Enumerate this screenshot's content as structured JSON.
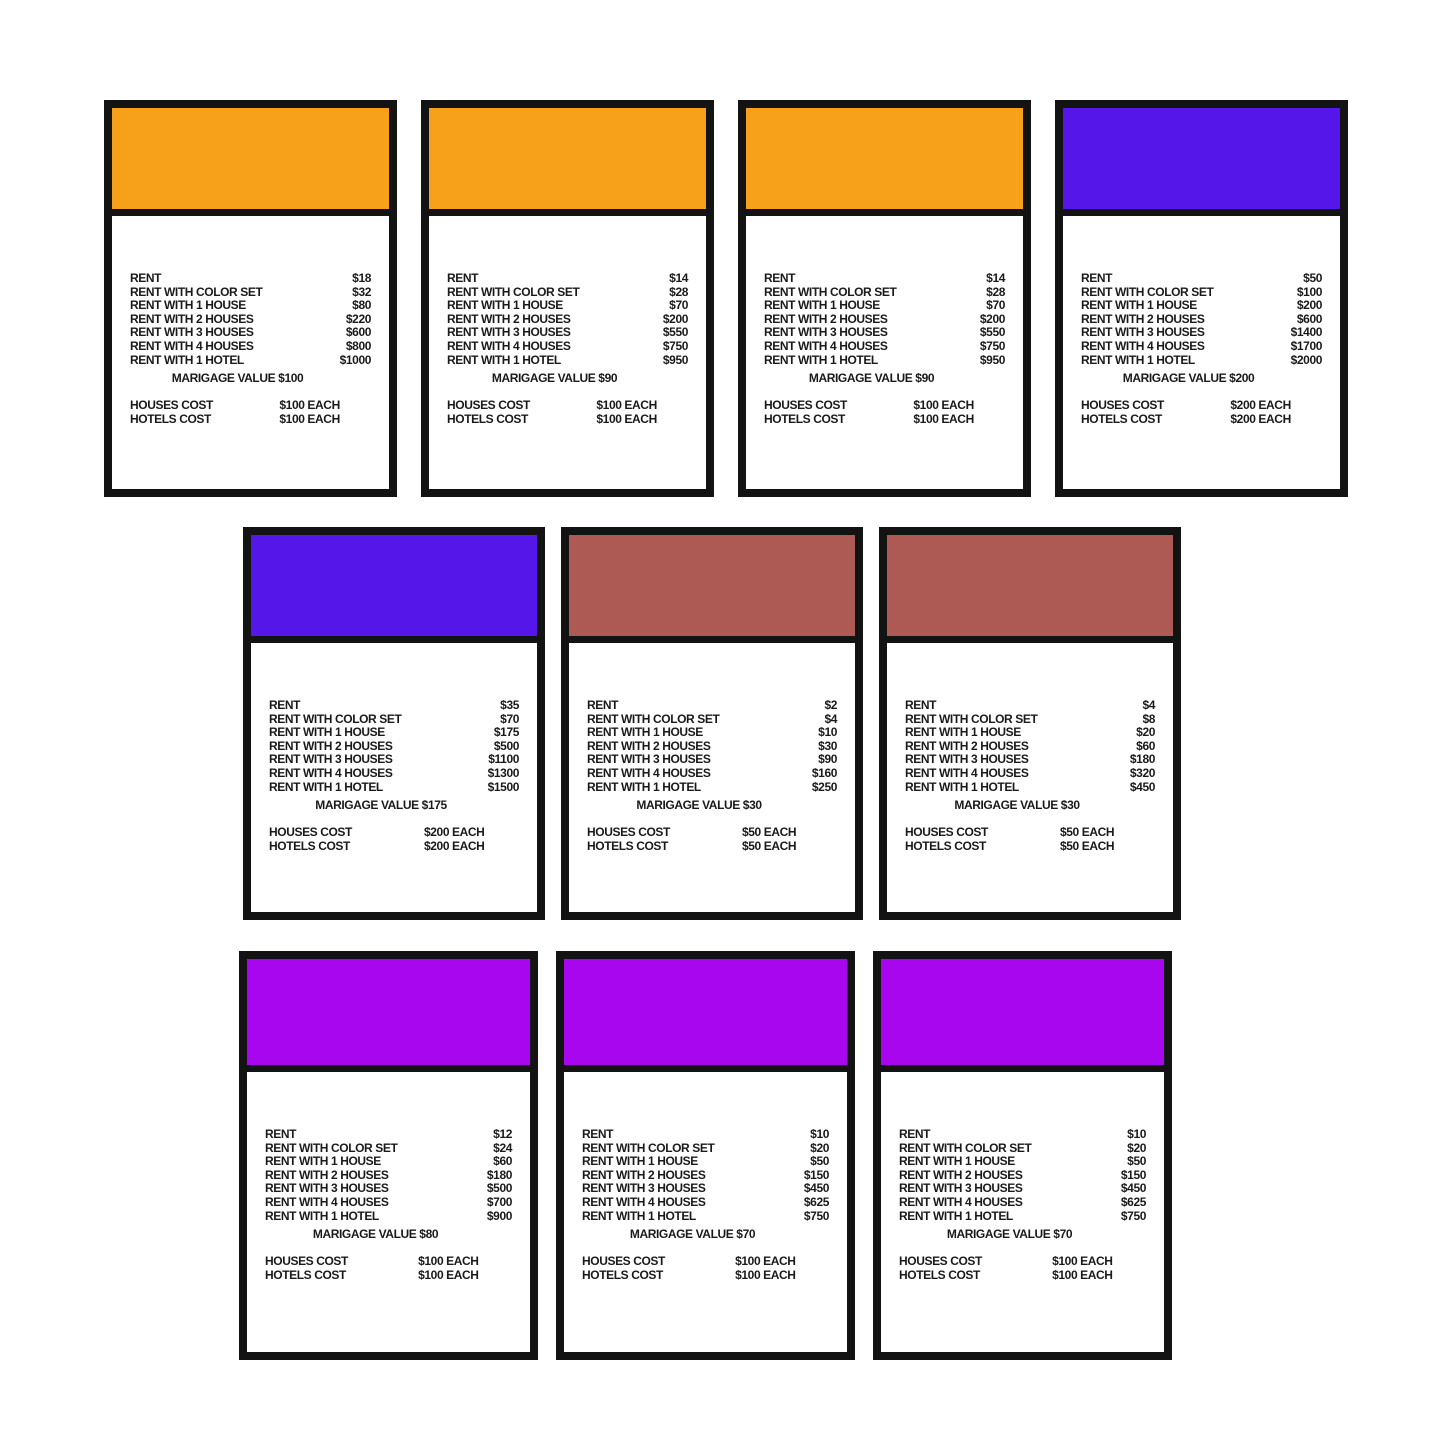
{
  "page": {
    "background": "#ffffff",
    "description": "grid of ten property rent cards"
  },
  "labels": {
    "rent": "RENT",
    "rent_with_color_set": "RENT WITH COLOR SET",
    "rent_with_1_house": "RENT WITH 1 HOUSE",
    "rent_with_2_houses": "RENT WITH 2 HOUSES",
    "rent_with_3_houses": "RENT WITH 3 HOUSES",
    "rent_with_4_houses": "RENT WITH 4 HOUSES",
    "rent_with_1_hotel": "RENT WITH 1 HOTEL",
    "houses_cost": "HOUSES COST",
    "hotels_cost": "HOTELS COST"
  },
  "colors": {
    "orange": "#F7A11B",
    "blue_violet": "#5517E9",
    "brown": "#AE5A54",
    "purple": "#A906F0",
    "card_border": "#131313",
    "text": "#1A1A1A"
  },
  "cards": [
    {
      "row": 0,
      "color": "orange",
      "band_color": "#F7A11B",
      "rent": "$18",
      "rent_with_color_set": "$32",
      "rent_with_1_house": "$80",
      "rent_with_2_houses": "$220",
      "rent_with_3_houses": "$600",
      "rent_with_4_houses": "$800",
      "rent_with_1_hotel": "$1000",
      "marigage_value": "MARIGAGE VALUE $100",
      "houses_cost": "$100 EACH",
      "hotels_cost": "$100 EACH"
    },
    {
      "row": 0,
      "color": "orange",
      "band_color": "#F7A11B",
      "rent": "$14",
      "rent_with_color_set": "$28",
      "rent_with_1_house": "$70",
      "rent_with_2_houses": "$200",
      "rent_with_3_houses": "$550",
      "rent_with_4_houses": "$750",
      "rent_with_1_hotel": "$950",
      "marigage_value": "MARIGAGE VALUE $90",
      "houses_cost": "$100 EACH",
      "hotels_cost": "$100 EACH"
    },
    {
      "row": 0,
      "color": "orange",
      "band_color": "#F7A11B",
      "rent": "$14",
      "rent_with_color_set": "$28",
      "rent_with_1_house": "$70",
      "rent_with_2_houses": "$200",
      "rent_with_3_houses": "$550",
      "rent_with_4_houses": "$750",
      "rent_with_1_hotel": "$950",
      "marigage_value": "MARIGAGE VALUE $90",
      "houses_cost": "$100 EACH",
      "hotels_cost": "$100 EACH"
    },
    {
      "row": 0,
      "color": "blue-violet",
      "band_color": "#5517E9",
      "rent": "$50",
      "rent_with_color_set": "$100",
      "rent_with_1_house": "$200",
      "rent_with_2_houses": "$600",
      "rent_with_3_houses": "$1400",
      "rent_with_4_houses": "$1700",
      "rent_with_1_hotel": "$2000",
      "marigage_value": "MARIGAGE VALUE $200",
      "houses_cost": "$200 EACH",
      "hotels_cost": "$200 EACH"
    },
    {
      "row": 1,
      "color": "blue-violet",
      "band_color": "#5517E9",
      "rent": "$35",
      "rent_with_color_set": "$70",
      "rent_with_1_house": "$175",
      "rent_with_2_houses": "$500",
      "rent_with_3_houses": "$1100",
      "rent_with_4_houses": "$1300",
      "rent_with_1_hotel": "$1500",
      "marigage_value": "MARIGAGE VALUE $175",
      "houses_cost": "$200 EACH",
      "hotels_cost": "$200 EACH"
    },
    {
      "row": 1,
      "color": "brown",
      "band_color": "#AE5A54",
      "rent": "$2",
      "rent_with_color_set": "$4",
      "rent_with_1_house": "$10",
      "rent_with_2_houses": "$30",
      "rent_with_3_houses": "$90",
      "rent_with_4_houses": "$160",
      "rent_with_1_hotel": "$250",
      "marigage_value": "MARIGAGE VALUE $30",
      "houses_cost": "$50 EACH",
      "hotels_cost": "$50 EACH"
    },
    {
      "row": 1,
      "color": "brown",
      "band_color": "#AE5A54",
      "rent": "$4",
      "rent_with_color_set": "$8",
      "rent_with_1_house": "$20",
      "rent_with_2_houses": "$60",
      "rent_with_3_houses": "$180",
      "rent_with_4_houses": "$320",
      "rent_with_1_hotel": "$450",
      "marigage_value": "MARIGAGE VALUE $30",
      "houses_cost": "$50 EACH",
      "hotels_cost": "$50 EACH"
    },
    {
      "row": 2,
      "color": "purple",
      "band_color": "#A906F0",
      "rent": "$12",
      "rent_with_color_set": "$24",
      "rent_with_1_house": "$60",
      "rent_with_2_houses": "$180",
      "rent_with_3_houses": "$500",
      "rent_with_4_houses": "$700",
      "rent_with_1_hotel": "$900",
      "marigage_value": "MARIGAGE VALUE $80",
      "houses_cost": "$100 EACH",
      "hotels_cost": "$100 EACH"
    },
    {
      "row": 2,
      "color": "purple",
      "band_color": "#A906F0",
      "rent": "$10",
      "rent_with_color_set": "$20",
      "rent_with_1_house": "$50",
      "rent_with_2_houses": "$150",
      "rent_with_3_houses": "$450",
      "rent_with_4_houses": "$625",
      "rent_with_1_hotel": "$750",
      "marigage_value": "MARIGAGE VALUE $70",
      "houses_cost": "$100 EACH",
      "hotels_cost": "$100 EACH"
    },
    {
      "row": 2,
      "color": "purple",
      "band_color": "#A906F0",
      "rent": "$10",
      "rent_with_color_set": "$20",
      "rent_with_1_house": "$50",
      "rent_with_2_houses": "$150",
      "rent_with_3_houses": "$450",
      "rent_with_4_houses": "$625",
      "rent_with_1_hotel": "$750",
      "marigage_value": "MARIGAGE VALUE $70",
      "houses_cost": "$100 EACH",
      "hotels_cost": "$100 EACH"
    }
  ]
}
